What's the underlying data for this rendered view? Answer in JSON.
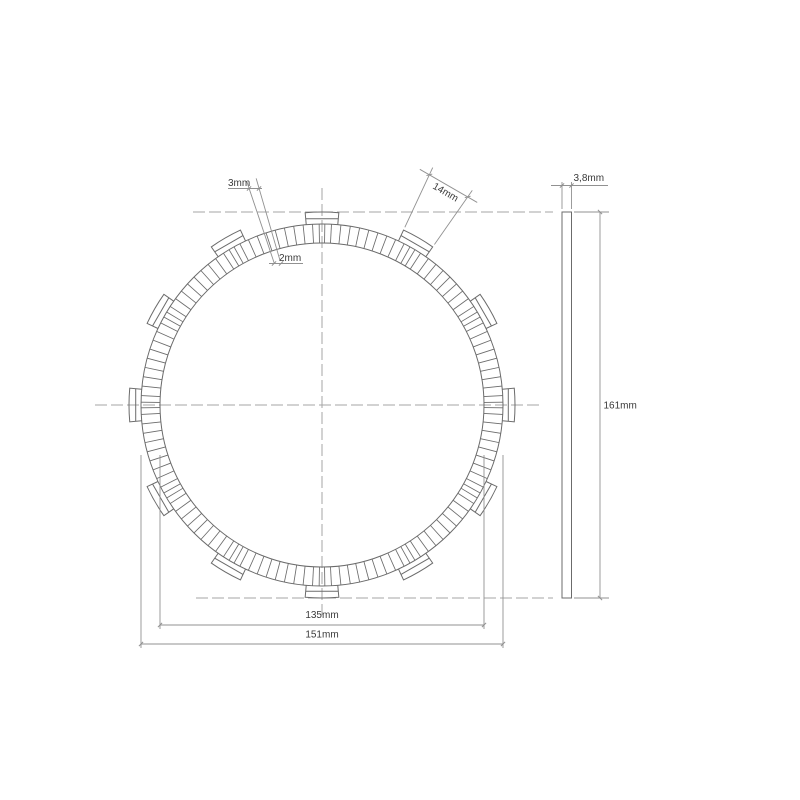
{
  "title": "clutch friction plate drawing",
  "colors": {
    "background": "#ffffff",
    "outline": "#6b6b6b",
    "centerline": "#a6a6a6",
    "dimension": "#919191",
    "text": "#3a3a3a"
  },
  "dimensions": {
    "groove_outer": "3mm",
    "groove_inner": "2mm",
    "tab_width": "14mm",
    "thickness": "3,8mm",
    "overall_height": "161mm",
    "inner_diameter": "135mm",
    "outer_diameter": "151mm"
  },
  "front_view": {
    "center": {
      "x": 322,
      "y": 405
    },
    "inner_radius": 162,
    "outer_radius": 181,
    "tab_outer_radius": 193,
    "tab_cap_radius": 187,
    "tab_count": 12,
    "tab_step_deg": 30,
    "tab_half_angle_deg": 5,
    "segment_step_deg": 3,
    "tab_center_pair_offset_deg": 0.9,
    "centerlines": {
      "horizontal": {
        "x1": 95,
        "y1": 405,
        "x2": 540,
        "y2": 405
      },
      "vertical": {
        "x1": 322,
        "y1": 188,
        "x2": 322,
        "y2": 615
      },
      "top_tangent": {
        "x1": 193,
        "y1": 212,
        "x2": 553,
        "y2": 212
      },
      "bottom_tangent": {
        "x1": 196,
        "y1": 598,
        "x2": 553,
        "y2": 598
      }
    },
    "groove_leaders": {
      "angles_deg": [
        106.2,
        108.6
      ],
      "r_inner": 150,
      "r_outer": 236
    },
    "tab_dim": {
      "tab_angle_deg": 60,
      "ext_r1": 196,
      "ext_r2": 262,
      "chord_r": 254,
      "label_pos": {
        "x": 444,
        "y": 195
      },
      "label_rotate_deg": 30
    }
  },
  "side_view": {
    "x": 562,
    "width": 9.5,
    "top": 212,
    "bottom": 598
  },
  "dim_layout": {
    "thickness": {
      "ext_y1": 182,
      "ext_y2": 209,
      "line_y": 185.5,
      "line_x1": 551,
      "line_x2": 608,
      "label_x": 573.5,
      "label_y": 181
    },
    "overall_height": {
      "line_x": 600,
      "ext_x1": 574,
      "ext_x2": 609,
      "label_x": 603.5,
      "label_y": 408.5
    },
    "inner_diameter": {
      "x1": 160,
      "x2": 484,
      "line_y": 625,
      "ext_y1": 455,
      "label_x": 322,
      "label_y": 618
    },
    "outer_diameter": {
      "x1": 141,
      "x2": 503,
      "line_y": 644,
      "ext_y1": 455,
      "label_x": 322,
      "label_y": 637.5
    },
    "groove_outer_label": {
      "x": 228,
      "y": 186,
      "ul_x1": 228,
      "ul_x2": 262,
      "ul_y": 188.5,
      "ticks_x": [
        249,
        259
      ]
    },
    "groove_inner_label": {
      "x": 279,
      "y": 261,
      "ul_x1": 269,
      "ul_x2": 303,
      "ul_y": 263.5,
      "ticks_x": [
        274,
        281
      ]
    }
  }
}
